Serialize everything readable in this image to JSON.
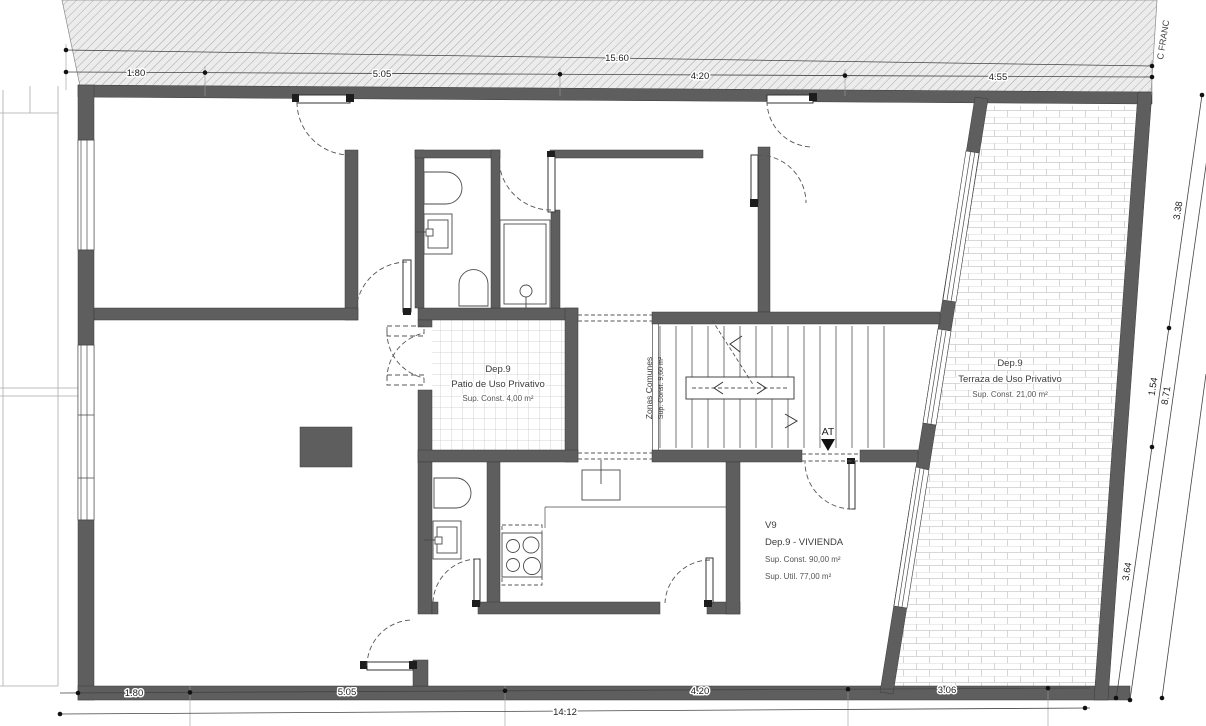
{
  "street_label": "C FRANC",
  "access_marker": "AT",
  "rooms": {
    "patio": {
      "id": "Dep.9",
      "name": "Patio de Uso Privativo",
      "area": "Sup. Const. 4,00 m²"
    },
    "terraza": {
      "id": "Dep.9",
      "name": "Terraza de Uso Privativo",
      "area": "Sup. Const. 21,00 m²"
    },
    "vivienda": {
      "code": "V9",
      "name": "Dep.9 - VIVIENDA",
      "area_const": "Sup. Const. 90,00 m²",
      "area_util": "Sup. Util. 77,00 m²"
    },
    "zonas_comunes": {
      "name": "Zonas Comunes",
      "area": "Sup. Const. 9,60 m²"
    }
  },
  "dimensions": {
    "top_overall": "15.60",
    "top_segments": [
      "1.80",
      "5.05",
      "4.20",
      "4.55"
    ],
    "bottom_segments": [
      "1.80",
      "5.05",
      "4.20",
      "3.06"
    ],
    "bottom_overall": "14.12",
    "right_segments": [
      "3.38",
      "1.54",
      "3.64"
    ],
    "right_overall": "8.71"
  },
  "colors": {
    "wall": "#5e5e5e",
    "line": "#3b3b3b",
    "dimension": "#222222",
    "hatch_bg": "#ececec",
    "hatch_line": "#a8a8a8",
    "tile_line": "#c9c9c9"
  }
}
